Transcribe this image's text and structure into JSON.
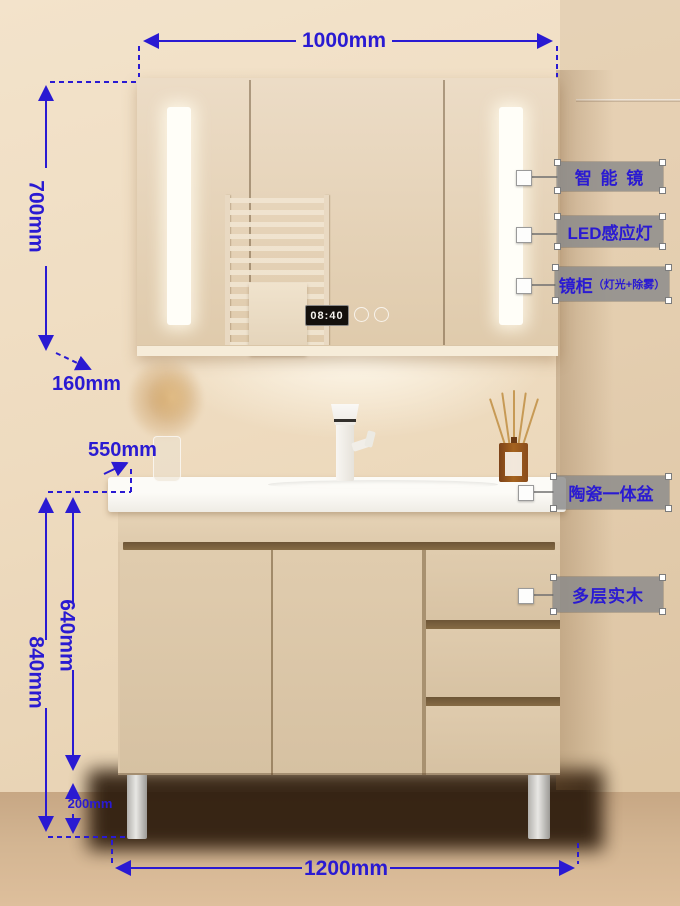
{
  "annotation_color": "#2a1ad2",
  "mirror_cabinet": {
    "clock_time": "08:40",
    "width": "1000mm",
    "height": "700mm",
    "depth": "160mm"
  },
  "vanity": {
    "counter_depth": "550mm",
    "body_height": "640mm",
    "total_height": "840mm",
    "leg_height": "200mm",
    "width": "1200mm"
  },
  "callouts": {
    "smart_mirror": "智 能 镜",
    "led_sensor_light": "LED感应灯",
    "mirror_cabinet_name": "镜柜",
    "mirror_cabinet_features": "（灯光+除雾）",
    "ceramic_basin": "陶瓷一体盆",
    "multilayer_wood": "多层实木"
  }
}
